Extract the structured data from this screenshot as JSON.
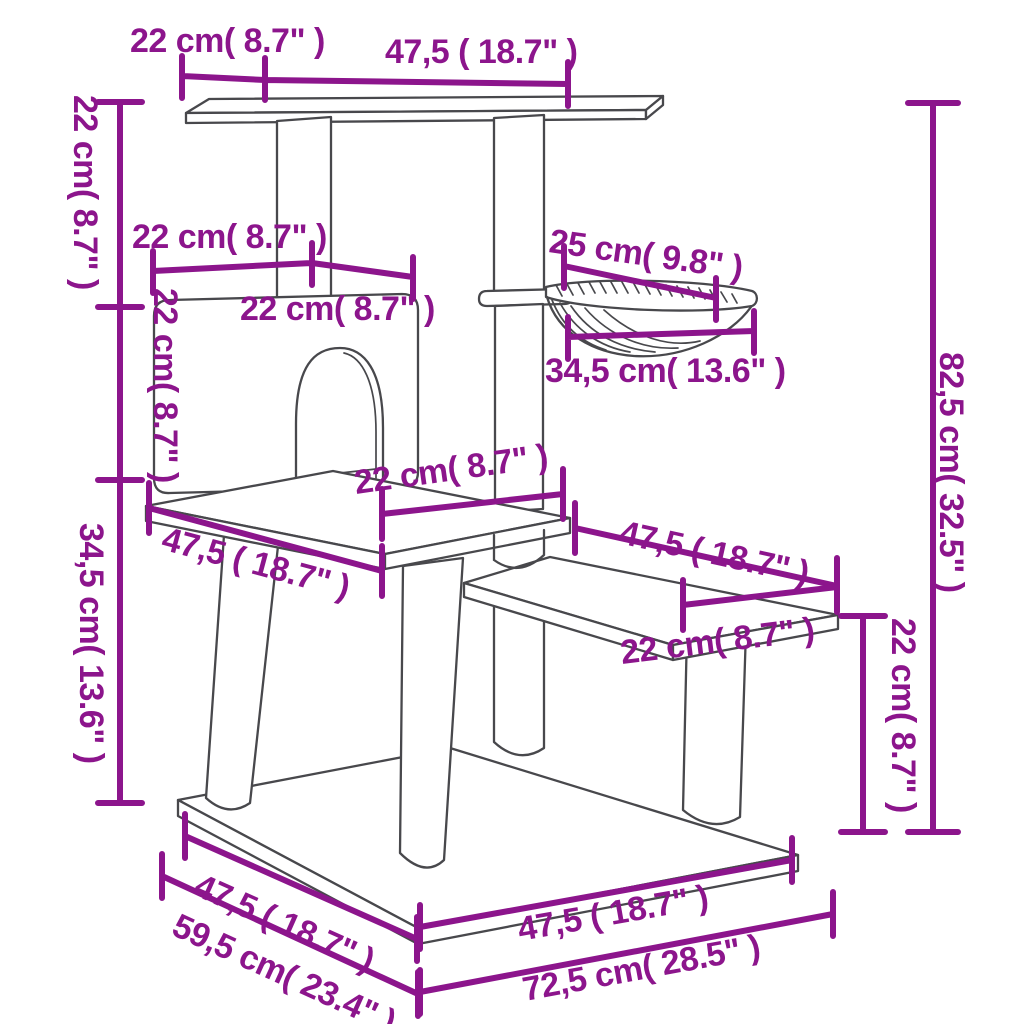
{
  "diagram": {
    "kind": "product-dimension-drawing",
    "subject": "cat tree with scratching posts, condo house, hammock, step platform and base",
    "colors": {
      "dimension": "#8C158C",
      "outline": "#48484C",
      "background": "#FFFFFF"
    }
  },
  "dims": {
    "top_left": "22 cm( 8.7\" )",
    "top": "47,5 ( 18.7\" )",
    "left_upper": "22 cm( 8.7\" )",
    "mid_left_a": "22 cm( 8.7\" )",
    "mid_left_b": "22 cm( 8.7\" )",
    "house_height": "22 cm( 8.7\" )",
    "hammock_top": "25 cm( 9.8\" )",
    "hammock_width": "34,5 cm( 13.6\" )",
    "right_height": "82,5 cm( 32.5\" )",
    "left_lower": "34,5 cm( 13.6\" )",
    "mid_platform": "22 cm( 8.7\" )",
    "mid_left_47": "47,5 ( 18.7\" )",
    "step_length": "47,5 ( 18.7\" )",
    "step_depth": "22 cm( 8.7\" )",
    "step_height": "22 cm( 8.7\" )",
    "base_left_top": "47,5 ( 18.7\" )",
    "base_left_bottom": "59,5 cm( 23.4\" )",
    "base_right_top": "47,5 ( 18.7\" )",
    "base_right_bottom": "72,5 cm( 28.5\" )"
  }
}
